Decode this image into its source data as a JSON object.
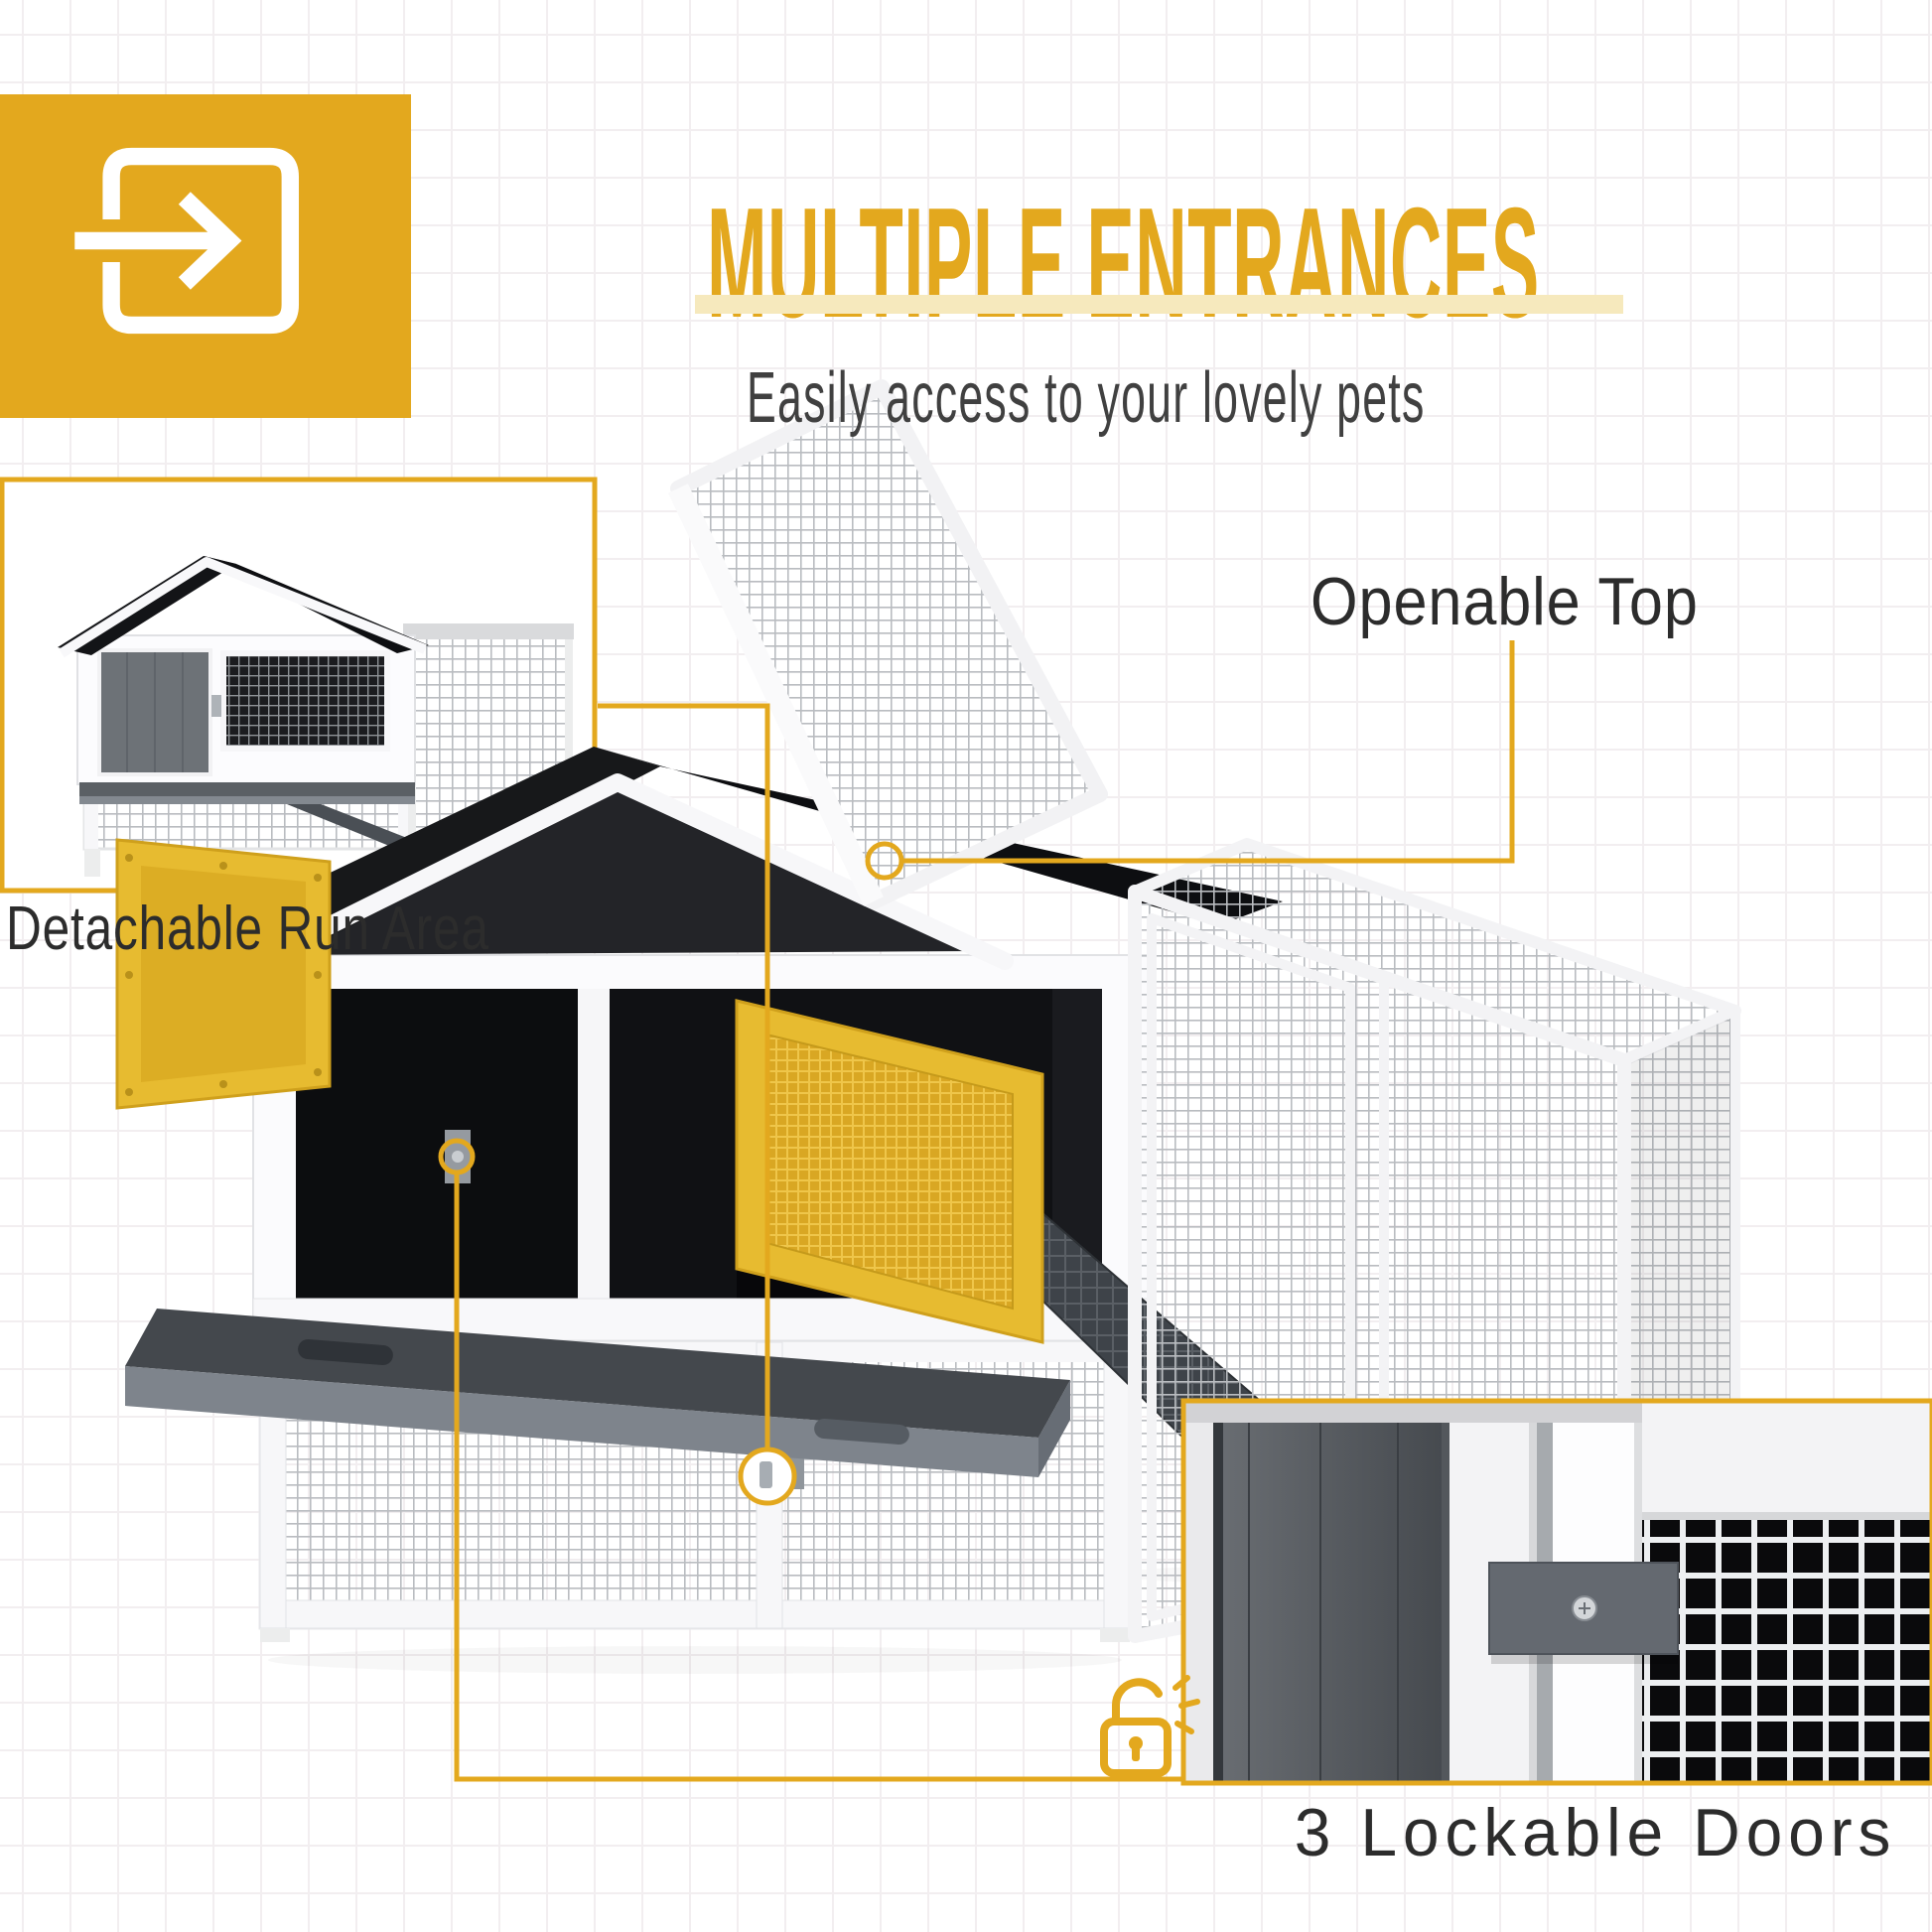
{
  "colors": {
    "accent": "#e3a81e",
    "accent_bar": "#f6e9bd",
    "heading_text": "#e3a81e",
    "label_text": "#2c2c2c",
    "subtitle_text": "#404040",
    "grid_line": "#f2eef0"
  },
  "header": {
    "icon": "enter-arrow-icon",
    "title": "MULTIPLE ENTRANCES",
    "subtitle": "Easily access to your lovely pets"
  },
  "callouts": {
    "detachable_run_area": {
      "label": "Detachable Run Area"
    },
    "openable_top": {
      "label": "Openable Top"
    },
    "lockable_doors": {
      "label": "3 Lockable Doors",
      "icon": "padlock-unlocked-icon"
    }
  }
}
